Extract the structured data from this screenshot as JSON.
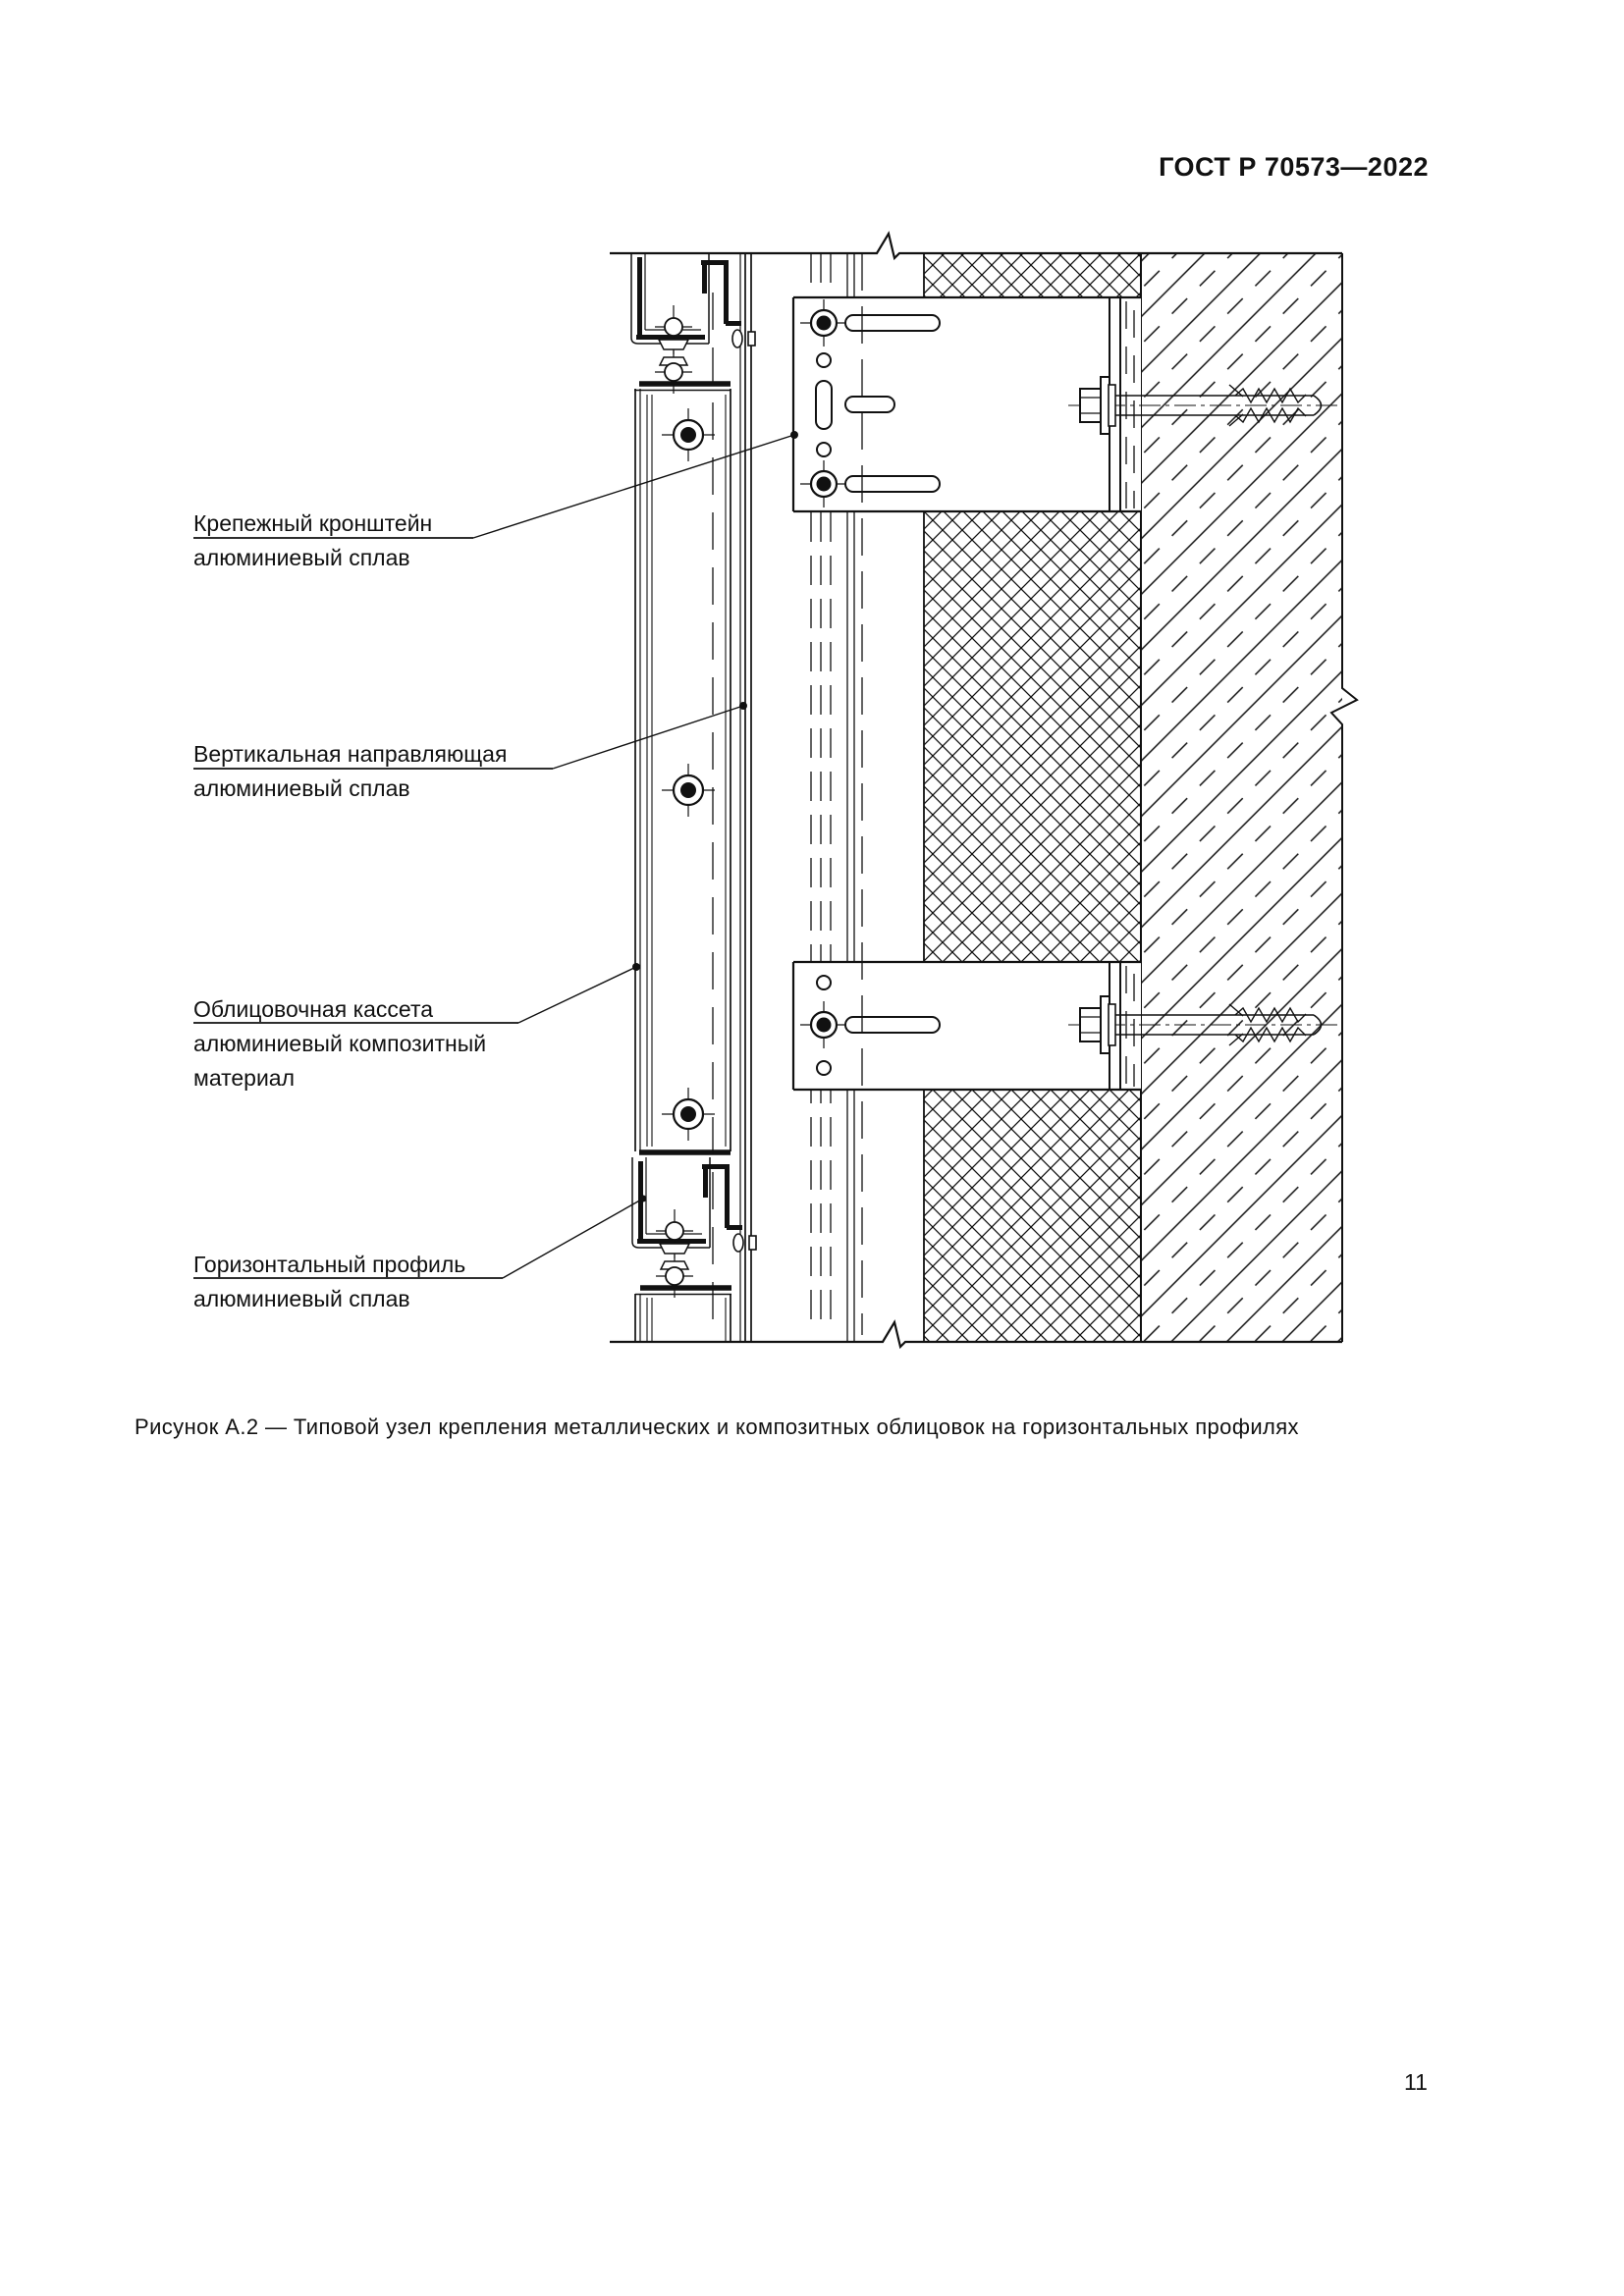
{
  "page": {
    "header": "ГОСТ Р 70573—2022",
    "page_number": "11"
  },
  "figure": {
    "caption": "Рисунок А.2 — Типовой узел крепления металлических и композитных облицовок на горизонтальных профилях",
    "labels": {
      "bracket": {
        "line1": "Крепежный кронштейн",
        "line2": "алюминиевый сплав"
      },
      "vertical_rail": {
        "line1": "Вертикальная направляющая",
        "line2": "алюминиевый сплав"
      },
      "cassette": {
        "line1": "Облицовочная кассета",
        "line2": "алюминиевый композитный",
        "line3": "материал"
      },
      "horizontal_profile": {
        "line1": "Горизонтальный профиль",
        "line2": "алюминиевый сплав"
      }
    }
  },
  "colors": {
    "ink": "#111111",
    "paper": "#ffffff"
  }
}
